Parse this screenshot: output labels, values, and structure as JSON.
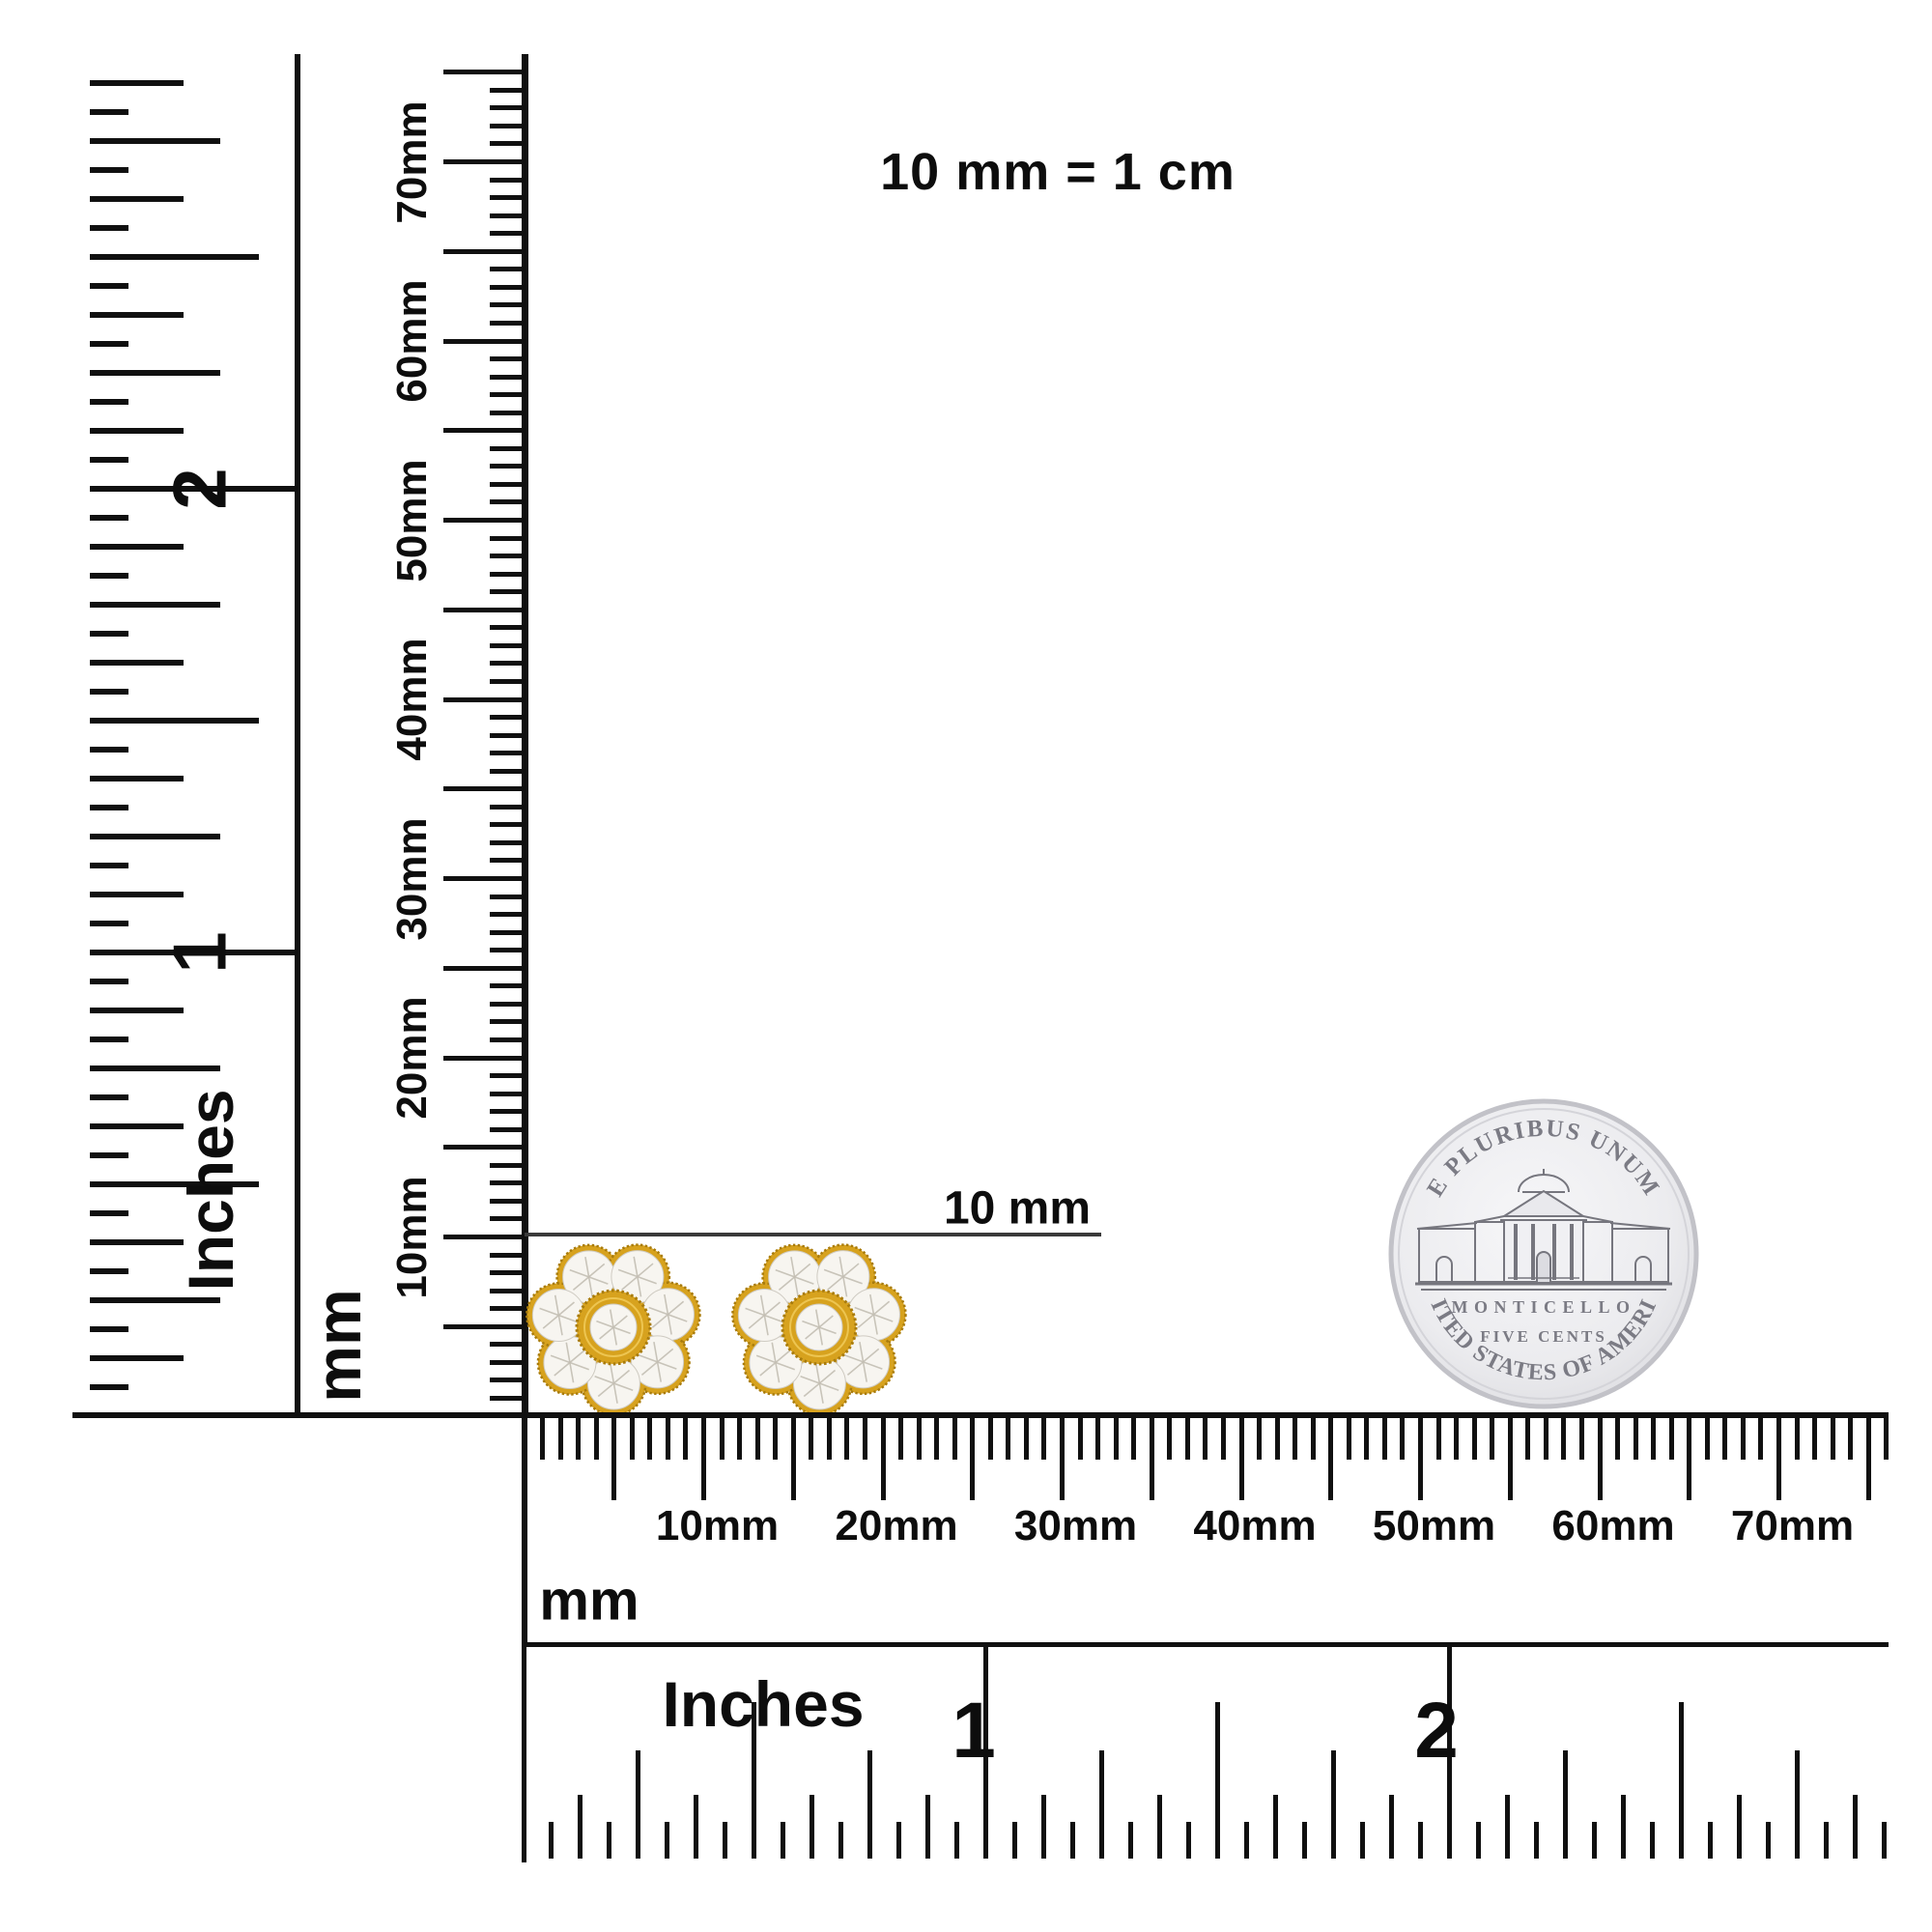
{
  "note_top": "10 mm = 1 cm",
  "measurement": {
    "label": "10 mm"
  },
  "left_inch_ruler": {
    "unit": "Inches",
    "numbers": [
      "1",
      "2"
    ]
  },
  "vertical_mm_ruler": {
    "unit": "mm",
    "labels": [
      "10mm",
      "20mm",
      "30mm",
      "40mm",
      "50mm",
      "60mm",
      "70mm"
    ]
  },
  "bottom_mm_ruler": {
    "unit": "mm",
    "labels": [
      "10mm",
      "20mm",
      "30mm",
      "40mm",
      "50mm",
      "60mm",
      "70mm"
    ]
  },
  "bottom_inch_ruler": {
    "unit": "Inches",
    "numbers": [
      "1",
      "2"
    ]
  },
  "coin": {
    "legend_top": "E PLURIBUS UNUM",
    "building": "MONTICELLO",
    "denomination": "FIVE CENTS",
    "legend_bottom": "UNITED STATES OF AMERICA"
  },
  "colors": {
    "ink": "#101010",
    "measure_line": "#3a3a3a",
    "gold": "#D7A21E",
    "gold_dark": "#A87B0C",
    "gold_light": "#F3CE5E",
    "diamond_white": "#F7F5F0",
    "facet_gray": "#C4BFB4",
    "coin_face": "#EFEFF2",
    "coin_edge": "#C2C2C8",
    "coin_engraving": "#7B7B84"
  }
}
